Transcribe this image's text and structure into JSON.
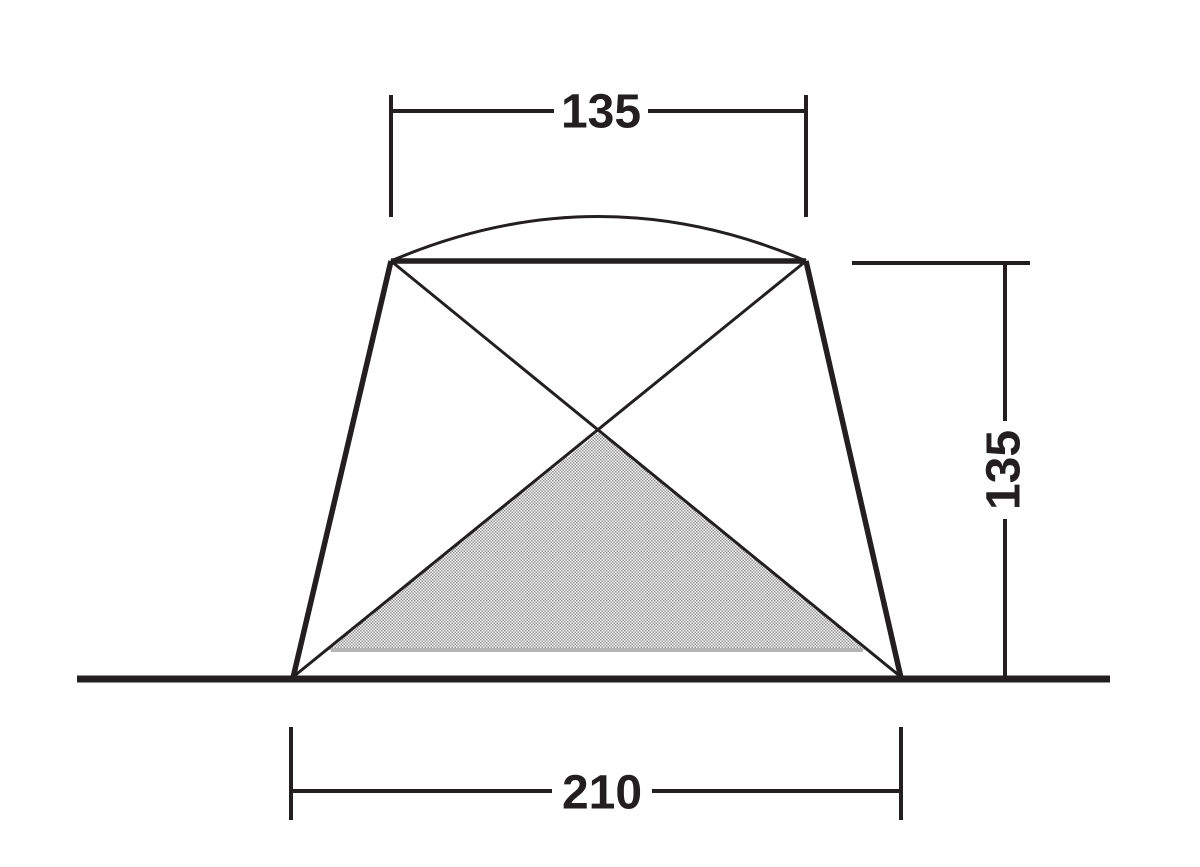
{
  "diagram": {
    "labels": {
      "top_width": "135",
      "side_height": "135",
      "base_width": "210"
    },
    "colors": {
      "line": "#231f20",
      "text": "#231f20",
      "shade_edge": "#b5b5b5",
      "shade_dot": "#8f8f8f",
      "background": "#ffffff"
    }
  }
}
